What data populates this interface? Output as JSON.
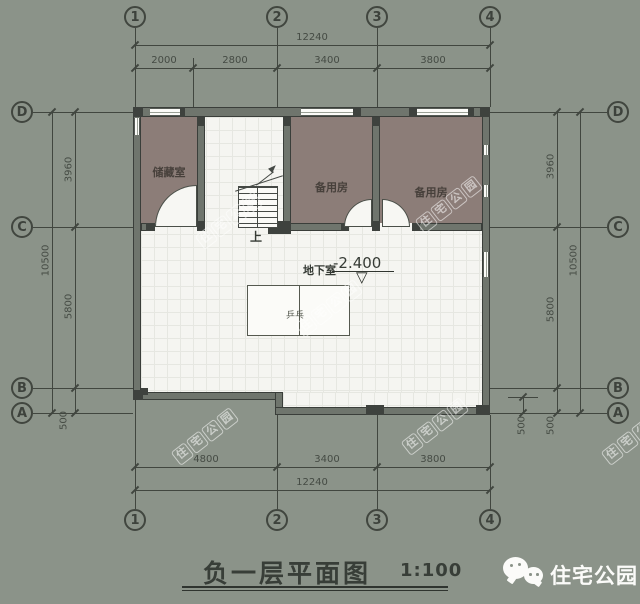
{
  "colors": {
    "background": "#8b9389",
    "wall_fill": "#6f756d",
    "wall_edge": "#3a3e3a",
    "column_dark": "#3e423e",
    "room_floor": "#8c7d78",
    "tile_floor": "#f5f5f1",
    "drawing_line": "#41463f",
    "white": "#fbfbf8"
  },
  "grid": {
    "top": [
      "1",
      "2",
      "3",
      "4"
    ],
    "bottom": [
      "1",
      "2",
      "3",
      "4"
    ],
    "left": [
      "D",
      "C",
      "B",
      "A"
    ],
    "right": [
      "D",
      "C",
      "B",
      "A"
    ]
  },
  "dims": {
    "top": {
      "total": "12240",
      "seg1": "2000",
      "seg2": "2800",
      "seg3": "3400",
      "seg4": "3800"
    },
    "bottom": {
      "total": "12240",
      "seg1": "4800",
      "seg2": "3400",
      "seg3": "3800"
    },
    "left": {
      "seg1": "3960",
      "seg2": "5800",
      "seg3": "500",
      "total": "10500"
    },
    "right": {
      "seg1": "3960",
      "seg2": "5800",
      "seg3": "500",
      "extra": "500",
      "total": "10500"
    }
  },
  "rooms": {
    "storage": "储藏室",
    "spare1": "备用房",
    "spare2": "备用房"
  },
  "annotations": {
    "floor_label": "地下室",
    "level_value": "-2.400",
    "level_symbol": "▽",
    "stair_up": "上",
    "table_label": "乒乓"
  },
  "title": {
    "text": "负一层平面图",
    "scale": "1:100"
  },
  "watermark": {
    "text": "住宅公园"
  },
  "logo": {
    "text": "住宅公园"
  }
}
